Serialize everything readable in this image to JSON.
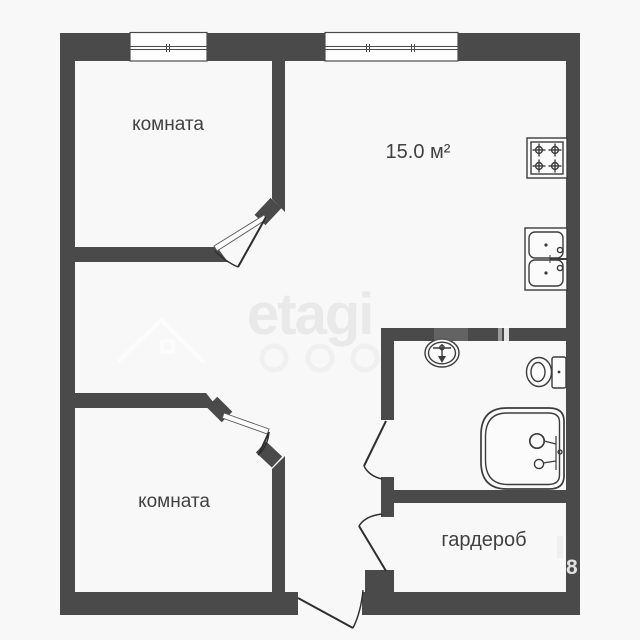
{
  "labels": {
    "room_top_left": "комната",
    "room_bottom_left": "комната",
    "kitchen_area": "15.0 м²",
    "wardrobe": "гардероб"
  },
  "watermark": {
    "logo_text": "etagi",
    "digit": "8"
  },
  "icons": {
    "fixtures": [
      "stove-icon",
      "kitchen-sink-icon",
      "bathroom-sink-icon",
      "toilet-icon",
      "bathtub-icon"
    ],
    "openings": [
      "window-icon",
      "door-swing-icon"
    ]
  },
  "colors": {
    "wall": "#4a4a4b",
    "background": "#f8f8f9",
    "fixture_line": "#3c3c3c",
    "label_text": "#414141",
    "watermark_gray": "#e9e9ea"
  }
}
